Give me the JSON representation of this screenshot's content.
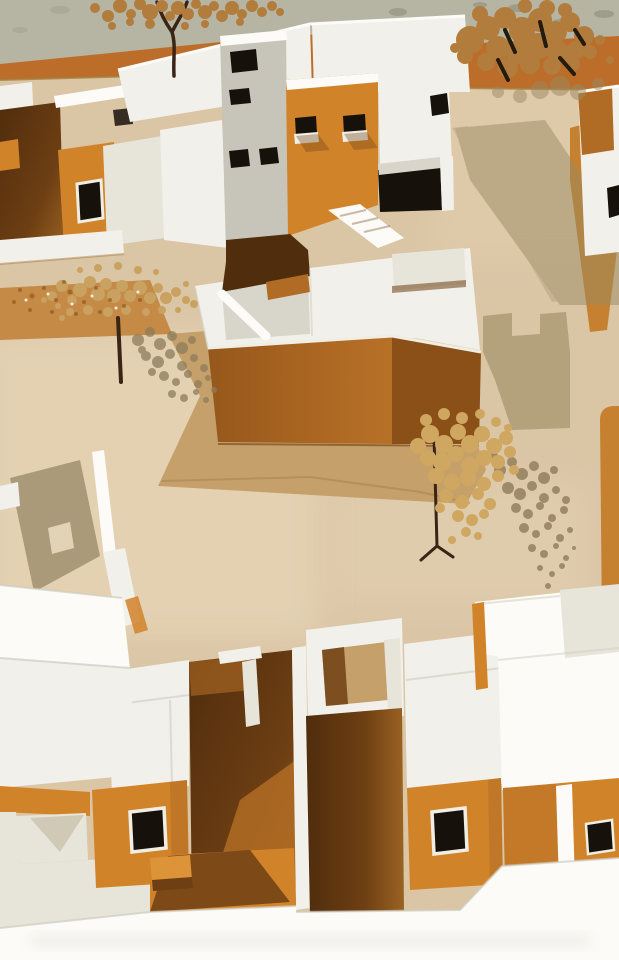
{
  "meta": {
    "type": "photograph",
    "subject": "architectural scale model",
    "description": "Aerial photograph of a cardboard architectural scale model: white-walled courtyard houses with orange-ochre wall faces and dark window openings arranged around a large central orange cube building on a tan baseboard, with paper cut-out trees casting lacy shadows, a concrete floor strip at top, deep brown shadowed courtyards and a white foreground wall."
  },
  "scene": {
    "objects": [
      "concrete-floor-strip",
      "ochre-base-edge-band",
      "tan-baseboard",
      "top-left-courtyard-house",
      "main-central-building",
      "central-orange-cube",
      "plaza",
      "ochre-path",
      "right-edge-house",
      "freestanding-wall",
      "tree-top-left",
      "tree-top-right",
      "tree-plaza",
      "tree-mid-right",
      "bottom-left-house-cluster",
      "bottom-right-house-cluster",
      "front-boundary-wall",
      "cast-shadows",
      "leaf-confetti"
    ]
  },
  "palette": {
    "concrete": "#b6b5a3",
    "concreteSpeckle": "#8a8b7a",
    "ochreBand": "#bc6d2a",
    "ochreBandEdge": "#a5803f",
    "path": "#c48a46",
    "ground": "#dac5a5",
    "groundLight": "#e9d9bc",
    "streetLight": "#e3cfae",
    "plaza": "#c6a06a",
    "plazaSeam": "#a98a55",
    "white": "#f2f0ea",
    "whiteBright": "#fcfbf7",
    "whiteDim": "#e7e4da",
    "whiteShaded": "#cfccc0",
    "grayFace": "#c7c4b9",
    "grayFace2": "#d8d5ca",
    "orange": "#d1832a",
    "orangeLight": "#dd9338",
    "orangeDeep": "#b06c24",
    "cubeFrontDark": "#96581b",
    "cubeFront": "#aa6522",
    "cubeFrontLight": "#b77127",
    "cubeSide": "#8a5017",
    "windowDark": "#17110b",
    "frame": "#f0ede3",
    "shadowDeep": "#502d0d",
    "shadowBrown": "#6e3f13",
    "shadowWarm": "#9a6322",
    "olive": "#9b8a62",
    "treeShadow": "#8d7c5a",
    "foliage": "#c9a160",
    "foliageDark": "#b27c3c",
    "foliagePale": "#cfa761",
    "trunk": "#3a2514",
    "twig": "#241b0f",
    "streetOrange": "#c5812f"
  }
}
